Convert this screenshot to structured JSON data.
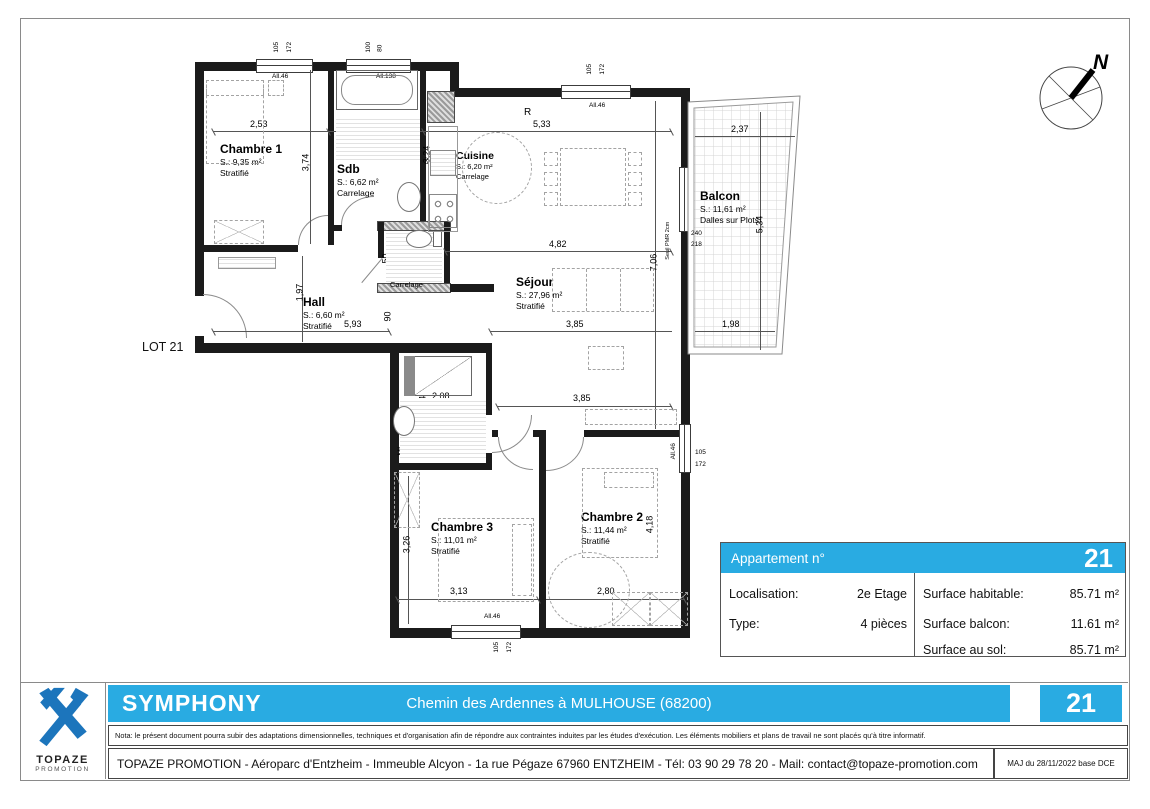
{
  "plan": {
    "lot_label": "LOT 21",
    "compass_north": "N",
    "rooms": [
      {
        "name": "Chambre 1",
        "area": "S.: 9,35 m²",
        "floor": "Stratifié"
      },
      {
        "name": "Sdb",
        "area": "S.: 6,62 m²",
        "floor": "Carrelage"
      },
      {
        "name": "Cuisine",
        "area": "S.: 6,20 m²",
        "floor": "Carrelage"
      },
      {
        "name": "Séjour",
        "area": "S.: 27,96 m²",
        "floor": "Stratifié"
      },
      {
        "name": "Wc",
        "area": "S.: 1,89 m²",
        "floor": "Carrelage"
      },
      {
        "name": "Hall",
        "area": "S.: 6,60 m²",
        "floor": "Stratifié"
      },
      {
        "name": "Balcon",
        "area": "S.: 11,61 m²",
        "floor": "Dalles sur Plots"
      },
      {
        "name": "Sdb",
        "area": "S.: 4,64 m²",
        "floor": "Carrelage"
      },
      {
        "name": "Chambre 3",
        "area": "S.: 11,01 m²",
        "floor": "Stratifié"
      },
      {
        "name": "Chambre 2",
        "area": "S.: 11,44 m²",
        "floor": "Stratifié"
      }
    ],
    "dims": {
      "c1_w": "2,53",
      "c1_h": "3,74",
      "sdb_w": "1,89",
      "sdb_h": "3,24",
      "cuisine_w": "5,33",
      "sejour_w": "4,82",
      "sejour_h": "7,06",
      "sejour_w2": "3,85",
      "c2zone_w": "3,85",
      "hall_w": "5,93",
      "hall_h": "1,97",
      "passage": "90",
      "wc_w": "1,33",
      "wc_d": "50",
      "balcon_top": "2,37",
      "balcon_side": "5,34",
      "balcon_bottom": "1,98",
      "door_h1": "240",
      "door_h2": "218",
      "sdb2_w": "2,08",
      "sdb2_h": "2,44",
      "c3_h": "3,26",
      "c3_w": "3,13",
      "c2_w": "2,80",
      "c2_h": "4,18"
    },
    "window_marks": {
      "win1_a": "105",
      "win1_b": "172",
      "win1_sill": "All.46",
      "win2_a": "100",
      "win2_b": "80",
      "win2_sill": "All.138",
      "win3_a": "105",
      "win3_b": "172",
      "win3_sill": "All.46",
      "win4_a": "105",
      "win4_b": "172",
      "win4_sill": "All.46",
      "win5_a": "105",
      "win5_b": "172",
      "win5_sill": "All.46"
    },
    "annotations": {
      "ml": "ML",
      "ml2": "ML",
      "r": "R",
      "ev": "EV",
      "seuil_pmr": "Seuil PMR 2cm"
    }
  },
  "info_table": {
    "header": "Appartement n°",
    "number": "21",
    "left_rows": [
      {
        "label": "Localisation:",
        "value": "2e Etage"
      },
      {
        "label": "Type:",
        "value": "4 pièces"
      }
    ],
    "right_rows": [
      {
        "label": "Surface habitable:",
        "value": "85.71 m²"
      },
      {
        "label": "Surface balcon:",
        "value": "11.61 m²"
      },
      {
        "label": "Surface au sol:",
        "value": "85.71 m²"
      }
    ]
  },
  "footer": {
    "project": "SYMPHONY",
    "address_line": "Chemin des Ardennes à MULHOUSE (68200)",
    "number": "21",
    "nota": "Nota: le présent document pourra subir des adaptations dimensionnelles, techniques et d'organisation afin de répondre aux contraintes induites par les études d'exécution. Les éléments mobiliers et plans de travail ne sont placés qu'à titre informatif.",
    "company_line": "TOPAZE PROMOTION - Aéroparc d'Entzheim - Immeuble Alcyon - 1a rue Pégaze 67960 ENTZHEIM - Tél: 03 90 29 78 20 - Mail: contact@topaze-promotion.com",
    "maj": "MAJ du 28/11/2022 base DCE"
  },
  "logo": {
    "name": "TOPAZE",
    "subtitle": "PROMOTION"
  },
  "colors": {
    "accent": "#29abe2",
    "logo_blue": "#1c75bc",
    "wall": "#1b1b1b"
  }
}
